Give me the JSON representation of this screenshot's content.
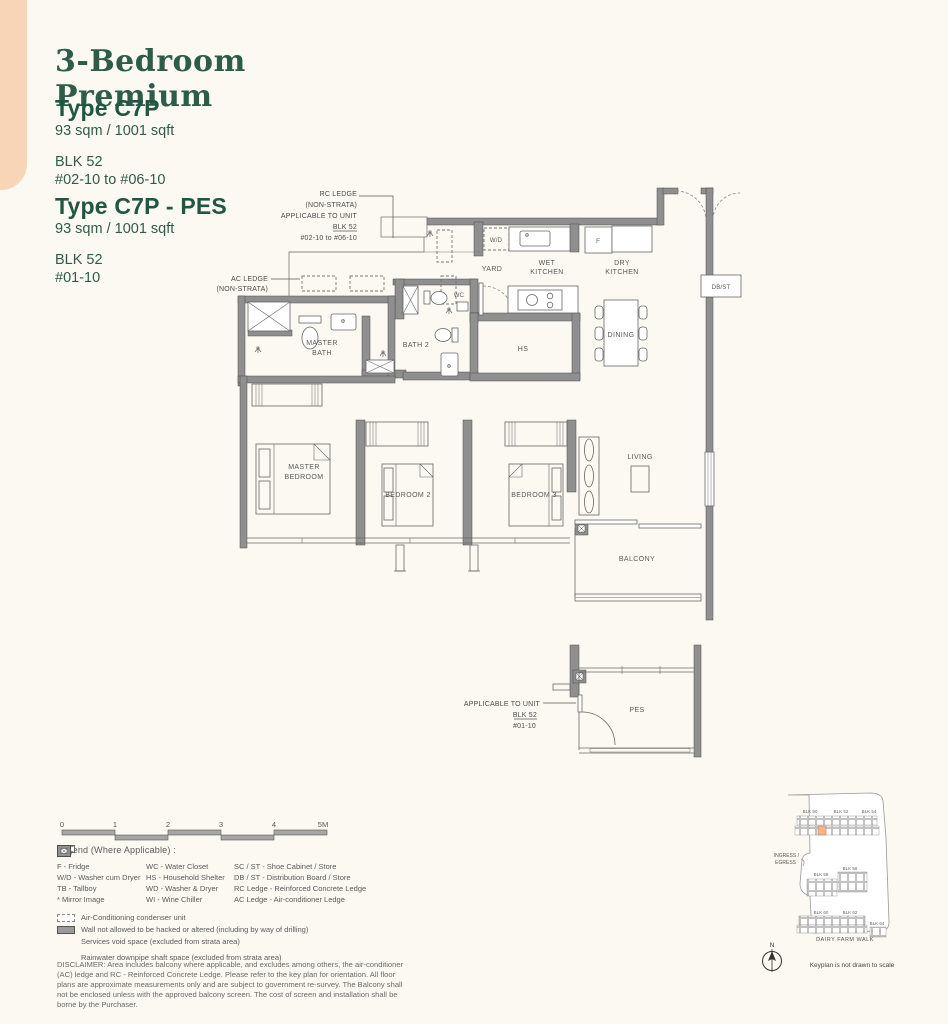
{
  "header": {
    "title": "3-Bedroom Premium",
    "type1": {
      "name": "Type C7P",
      "area": "93 sqm / 1001 sqft",
      "block": "BLK 52",
      "units": "#02-10 to #06-10"
    },
    "type2": {
      "name": "Type C7P - PES",
      "area": "93 sqm / 1001 sqft",
      "block": "BLK 52",
      "units": "#01-10"
    }
  },
  "floorplan": {
    "rooms": {
      "yard": "YARD",
      "wet_kitchen": [
        "WET",
        "KITCHEN"
      ],
      "dry_kitchen": [
        "DRY",
        "KITCHEN"
      ],
      "dining": "DINING",
      "wc": "WC",
      "bath2": "BATH 2",
      "hs": "HS",
      "master_bath": [
        "MASTER",
        "BATH"
      ],
      "master_bedroom": [
        "MASTER",
        "BEDROOM"
      ],
      "bedroom2": "BEDROOM 2",
      "bedroom3": "BEDROOM 3",
      "living": "LIVING",
      "balcony": "BALCONY",
      "pes": "PES"
    },
    "fixtures": {
      "wd": "W/D",
      "fridge": "F",
      "db_st": "DB/ST"
    },
    "notes": {
      "rc_ledge": [
        "RC LEDGE",
        "(NON-STRATA)",
        "APPLICABLE TO UNIT",
        "BLK 52",
        "#02-10 to #06-10"
      ],
      "ac_ledge": [
        "AC LEDGE",
        "(NON-STRATA)"
      ],
      "pes": [
        "APPLICABLE TO UNIT",
        "BLK 52",
        "#01-10"
      ]
    }
  },
  "scalebar": {
    "ticks": [
      "0",
      "1",
      "2",
      "3",
      "4",
      "5M"
    ]
  },
  "legend": {
    "heading": "Legend (Where Applicable) :",
    "columns": [
      [
        "F - Fridge",
        "W/D - Washer cum Dryer",
        "TB - Tallboy",
        "* Mirror Image"
      ],
      [
        "WC - Water Closet",
        "HS - Household Shelter",
        "WD - Washer & Dryer",
        "WI - Wine Chiller"
      ],
      [
        "SC / ST - Shoe Cabinet / Store",
        "DB / ST - Distribution Board / Store",
        "RC Ledge - Reinforced Concrete Ledge",
        "AC Ledge - Air-conditioner Ledge"
      ]
    ],
    "symbols": [
      "Air-Conditioning condenser unit",
      "Wall not allowed to be hacked or altered (including by way of drilling)",
      "Services void space (excluded from strata area)",
      "Rainwater downpipe shaft space (excluded from strata area)"
    ]
  },
  "disclaimer": "DISCLAIMER: Area includes balcony where applicable, and excludes among others, the air-conditioner (AC) ledge and RC - Reinforced Concrete Ledge. Please refer to the key plan for orientation. All floor plans are approximate measurements only and are subject to government re-survey. The Balcony shall not be enclosed unless with the approved balcony screen. The cost of screen and installation shall be borne by the Purchaser.",
  "keyplan": {
    "blocks_row1": [
      "BLK 50",
      "BLK 52",
      "BLK 54"
    ],
    "blocks_row2": [
      "BLK 58",
      "BLK 56"
    ],
    "blocks_row3": [
      "BLK 60",
      "BLK 62",
      "BLK 64"
    ],
    "ingress": [
      "INGRESS /",
      "EGRESS"
    ],
    "street": "DAIRY FARM WALK",
    "north": "N",
    "note": "Keyplan is not drawn to scale"
  },
  "colors": {
    "accent_green": "#2d5c49",
    "peach": "#f8d5b6",
    "wall_gray": "#8f8f8f",
    "highlight_orange": "#f3b488"
  }
}
